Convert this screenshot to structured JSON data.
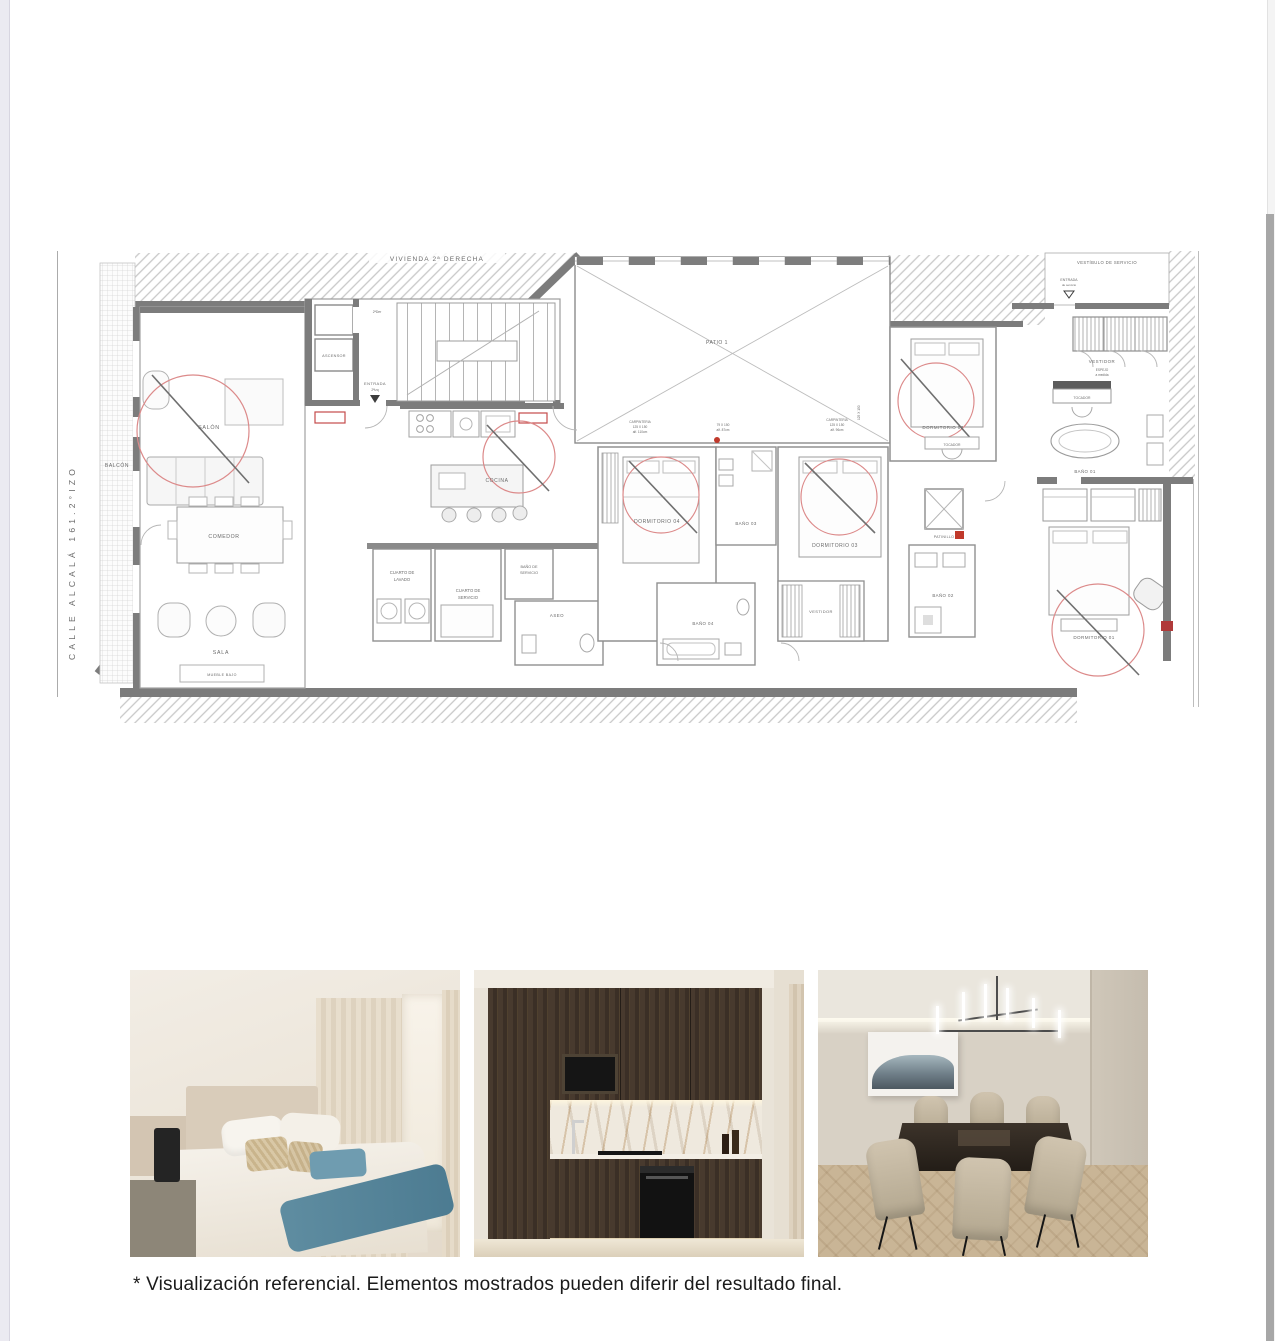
{
  "document": {
    "disclaimer": "* Visualización referencial. Elementos mostrados pueden diferir del resultado final."
  },
  "plan": {
    "street_label": "CALLE ALCALÁ 161.2°IZO",
    "neighbor_dwelling": "VIVIENDA 2ª DERECHA",
    "patio": "PATIO 1",
    "rooms": {
      "balcon": "BALCÓN",
      "salon": "SALÓN",
      "comedor": "COMEDOR",
      "sala": "SALA",
      "mueble_bajo": "MUEBLE BAJO",
      "ascensor": "ASCENSOR",
      "entrada": "ENTRADA",
      "entrada_sub": "2ªIzq",
      "puerta_derecha": "2ªDer",
      "cocina": "COCINA",
      "cuarto_de_lavado_1": "CUARTO DE",
      "cuarto_de_lavado_2": "LAVADO",
      "cuarto_de_servicio_1": "CUARTO DE",
      "cuarto_de_servicio_2": "SERVICIO",
      "bano_de_servicio_1": "BAÑO DE",
      "bano_de_servicio_2": "SERVICIO",
      "aseo": "ASEO",
      "dormitorio_04": "DORMITORIO 04",
      "bano_04": "BAÑO 04",
      "bano_03": "BAÑO 03",
      "dormitorio_03": "DORMITORIO 03",
      "vestidor_d03": "VESTIDOR",
      "patinillo": "PATINILLO",
      "bano_02": "BAÑO 02",
      "dormitorio_02": "DORMITORIO 02",
      "tocador_d02": "TOCADOR",
      "vestibulo_de_servicio": "VESTÍBULO DE SERVICIO",
      "entrada_servicio_1": "ENTRADA",
      "entrada_servicio_2": "de servicio",
      "vestidor_master": "VESTIDOR",
      "espejo_1": "ESPEJO",
      "espejo_2": "a medida",
      "tocador_master": "TOCADOR",
      "bano_01": "BAÑO 01",
      "dormitorio_01": "DORMITORIO 01"
    },
    "annotations": {
      "carp_a_1": "CARPINTERIA",
      "carp_a_2": "125 X 150",
      "carp_a_3": "alf. 110cm",
      "carp_b_1": "79 X 150",
      "carp_b_2": "alf. 87cm",
      "carp_c_1": "CARPINTERIA",
      "carp_c_2": "125 X 150",
      "carp_c_3": "alf. 96cm",
      "carp_d": "125 X 150"
    }
  },
  "photos": {
    "items": [
      "bedroom-render",
      "kitchen-render",
      "dining-room-render"
    ]
  }
}
